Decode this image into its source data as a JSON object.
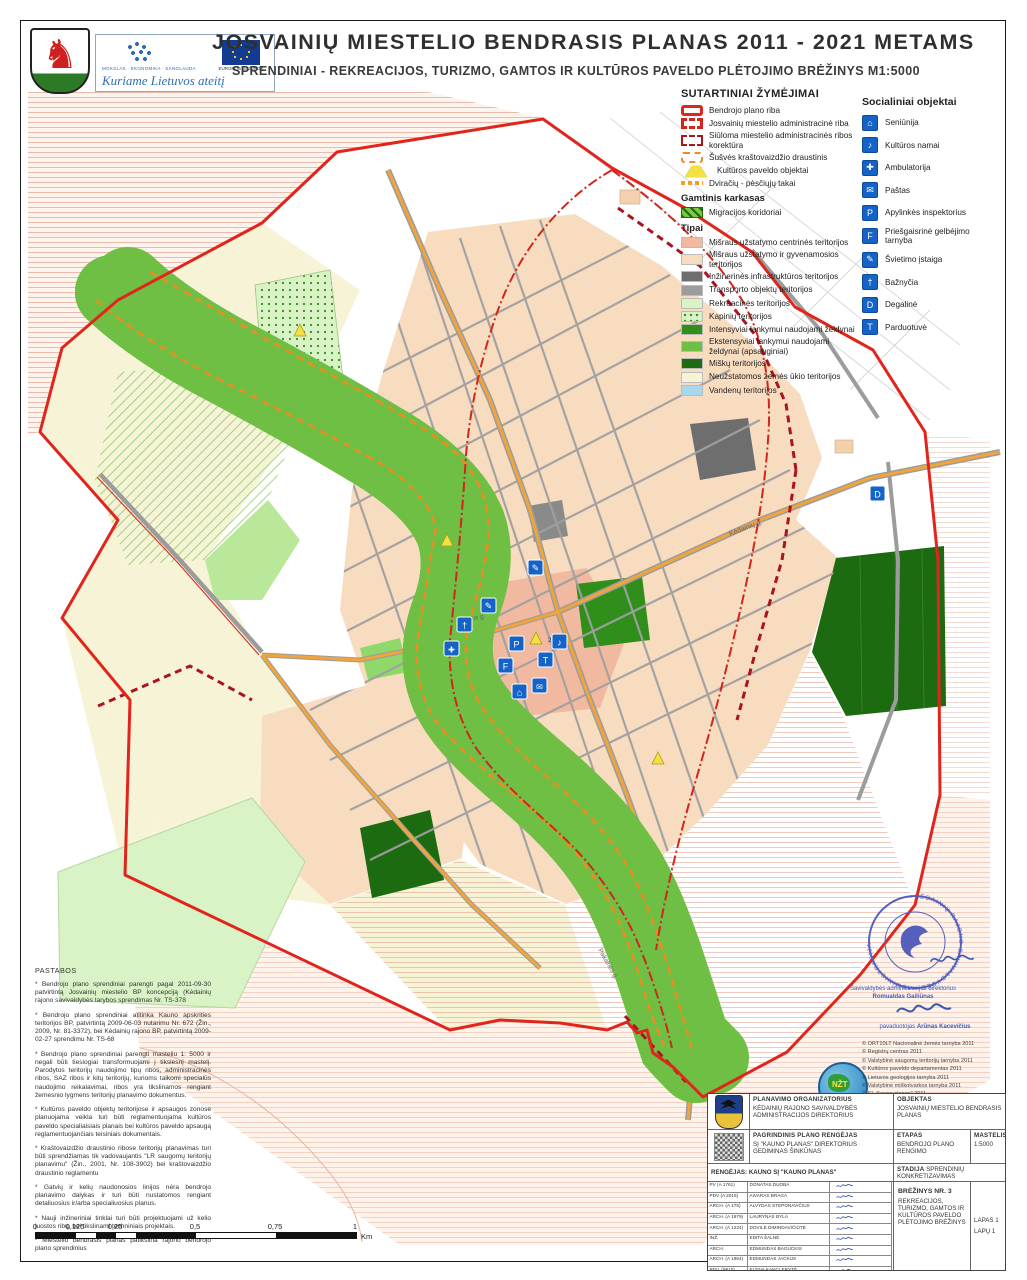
{
  "header": {
    "title": "JOSVAINIŲ MIESTELIO BENDRASIS PLANAS 2011 - 2021 METAMS",
    "subtitle": "SPRENDINIAI - REKREACIJOS, TURIZMO, GAMTOS IR KULTŪROS PAVELDO PLĖTOJIMO BRĖŽINYS M1:5000",
    "program_line": "MOKSLAS · EKONOMIKA · SANGLAUDA",
    "program_slogan": "Kuriame Lietuvos ateitį",
    "eu_label": "EUROPOS SĄJUNGA"
  },
  "legend": {
    "title": "SUTARTINIAI ŽYMĖJIMAI",
    "boundary_items": [
      {
        "label": "Bendrojo plano riba"
      },
      {
        "label": "Josvainių miestelio administracinė riba"
      },
      {
        "label": "Siūloma miestelio administracinės ribos korektūra"
      },
      {
        "label": "Šušvės kraštovaizdžio draustinis"
      },
      {
        "label": "Kultūros paveldo objektai"
      },
      {
        "label": "Dviračių - pėsčiųjų takai"
      }
    ],
    "nature_title": "Gamtinis karkasas",
    "nature_items": [
      {
        "label": "Migracijos koridoriai"
      }
    ],
    "types_title": "Tipai",
    "type_items": [
      {
        "label": "Mišraus užstatymo centrinės teritorijos",
        "color": "#f2b9a1"
      },
      {
        "label": "Mišraus užstatymo ir gyvenamosios teritorijos",
        "color": "#f8dcc0"
      },
      {
        "label": "Inžinerinės infrastruktūros teritorijos",
        "color": "#6e6e6e"
      },
      {
        "label": "Transporto objektų teritorijos",
        "color": "#9c9c9c"
      },
      {
        "label": "Rekreacinės teritorijos",
        "color": "#d9f2c6"
      },
      {
        "label": "Kapinių teritorijos",
        "color": "#d9f2c6"
      },
      {
        "label": "Intensyviai lankymui naudojami želdynai",
        "color": "#2f8f1a"
      },
      {
        "label": "Ekstensyviai lankymui naudojami želdynai (apsauginiai)",
        "color": "#6fbf44"
      },
      {
        "label": "Miškų teritorijos",
        "color": "#1d6b10"
      },
      {
        "label": "Neužstatomos žemės ūkio teritorijos",
        "color": "#f7f3d7"
      },
      {
        "label": "Vandenų teritorijos",
        "color": "#a8d8ee"
      }
    ]
  },
  "social": {
    "title": "Socialiniai objektai",
    "items": [
      {
        "label": "Seniūnija",
        "glyph": "⌂"
      },
      {
        "label": "Kultūros namai",
        "glyph": "♪"
      },
      {
        "label": "Ambulatorija",
        "glyph": "✚"
      },
      {
        "label": "Paštas",
        "glyph": "✉"
      },
      {
        "label": "Apylinkės inspektorius",
        "glyph": "P"
      },
      {
        "label": "Priešgaisrinė gelbėjimo tarnyba",
        "glyph": "F"
      },
      {
        "label": "Švietimo įstaiga",
        "glyph": "✎"
      },
      {
        "label": "Bažnyčia",
        "glyph": "†"
      },
      {
        "label": "Degalinė",
        "glyph": "D"
      },
      {
        "label": "Parduotuvė",
        "glyph": "T"
      }
    ]
  },
  "map_labels": {
    "street1": "Kėdainių g.",
    "street2": "Gojaus g.",
    "street3": "Pakalnės g.",
    "heritage_no": "21311"
  },
  "notes": {
    "title": "PASTABOS",
    "paragraphs": [
      "* Bendrojo plano sprendiniai parengti pagal 2011-09-30 patvirtintą Josvainių miestelio BP koncepciją (Kėdainių rajono savivaldybės tarybos sprendimas Nr. TS-378",
      "* Bendrojo plano sprendiniai atitinka Kauno apskrities teritorijos BP, patvirtintą 2009-06-03 nutarimu Nr. 672 (Žin., 2009, Nr. 81-3372), bei Kėdainių rajono BP, patvirtintą 2009-02-27 sprendimu Nr. TS-68",
      "* Bendrojo plano sprendiniai parengti masteliu 1: 5000 ir negali būti tiesiogiai transformuojami į tikslesnį mastelį. Parodytos teritorijų naudojimo tipų ribos, administracinės ribos, SAZ ribos ir kitų teritorijų, kurioms taikomi specialūs naudojimo reikalavimai, ribos yra tikslinamos rengiant žemesnio lygmens teritorijų planavimo dokumentus.",
      "* Kultūros paveldo objektų teritorijose ir apsaugos zonose planuojama veikla turi būti reglamentuojama kultūros paveldo specialiaisiais planais bei kultūros paveldo apsaugą reglamentuojančiais teisiniais dokumentais.",
      "* Kraštovaizdžio draustinio ribose teritorijų planavimas turi būti sprendžiamas tik vadovaujantis \"LR saugomų teritorijų planavimu\" (Žin., 2001, Nr. 108-3902) bei kraštovaizdžio draustinio reglamentu",
      "* Gatvių ir kelių naudonosios linijos nėra bendrojo planavimo dalykas ir turi būti nustatomos rengiant detaliuosius ir/arba specialiuosius planus.",
      "* Nauji inžineriniai tinklai turi būti projektuojami už kelio juostos ribų, bei tikslinami techniniais projektais.",
      "* Miestelio bendrasis planas patikslina rajono bendrojo plano sprendinius"
    ]
  },
  "scalebar": {
    "ticks": [
      "0",
      "0,125",
      "0,25",
      "0,5",
      "0,75",
      "1"
    ],
    "unit": "Km"
  },
  "credits": {
    "lines": [
      "© ORT10LT Nacionalinė žemės tarnyba  2011",
      "© Registrų centras 2011",
      "© Valstybinė saugomų teritorijų tarnyba 2011",
      "© Kultūros paveldo departamentas 2011",
      "© Lietuvos geologijos tarnyba 2011",
      "© Valstybinė miškotvarkos tarnyba 2011",
      "© SĮ „Kauno planas\" 2011",
      "© Kėdainių rajono savivaldybė  2011",
      "Atlikta naudojant ArcGIS programinę įrangą"
    ]
  },
  "stamp": {
    "ring_text": "KĖDAINIŲ RAJONO SAVIVALDYBĖS • ADMINISTRACIJA •",
    "sig1_role": "Savivaldybės administracijos direktorius",
    "sig1_name": "Romualdas Gailiūnas",
    "sig2_role": "pavaduotojas",
    "sig2_name": "Arūnas Kacevičius"
  },
  "titleblock": {
    "org_label": "PLANAVIMO ORGANIZATORIUS",
    "org_value": "KĖDAINIŲ RAJONO SAVIVALDYBĖS ADMINISTRACIJOS DIREKTORIUS",
    "obj_label": "OBJEKTAS",
    "obj_value": "JOSVAINIŲ MIESTELIO BENDRASIS PLANAS",
    "reng_label": "PAGRINDINIS PLANO RENGĖJAS",
    "reng_value": "SĮ \"KAUNO PLANAS\" DIREKTORIUS GEDIMINAS ŠINKŪNAS",
    "etapas_label": "ETAPAS",
    "etapas_value": "BENDROJO PLANO RENGIMO",
    "mastelis_label": "MASTELIS",
    "mastelis_value": "1:5000",
    "rengejas_row": "RENGĖJAS: KAUNO SĮ \"KAUNO PLANAS\"",
    "stadija_label": "STADIJA",
    "stadija_value": "SPRENDINIŲ KONKRETIZAVIMAS",
    "brezinys_label": "BRĖŽINYS NR. 3",
    "brezinys_value": "REKREACIJOS, TURIZMO, GAMTOS IR KULTŪROS PAVELDO PLĖTOJIMO BRĖŽINYS",
    "lapas": "LAPAS 1",
    "lapu": "LAPŲ 1",
    "team": [
      {
        "code": "PV (A 1761)",
        "name": "DONATAS DUOBA"
      },
      {
        "code": "PDV (A 2015)",
        "name": "AIVARAS BRAGA"
      },
      {
        "code": "ARCH. (A 175)",
        "name": "ALVYDAS STEPONAVIČIUS"
      },
      {
        "code": "ARCH. (A 1979)",
        "name": "LAURYNAS BYLA"
      },
      {
        "code": "ARCH. (A 1224)",
        "name": "DOVILĖ DIMINDAVIČIŪTĖ"
      },
      {
        "code": "INŽ.",
        "name": "EDITA ŠALNĖ"
      },
      {
        "code": "ARCH.",
        "name": "EDMUNDAS BAGUCKIS"
      },
      {
        "code": "ARCH. (A 1964)",
        "name": "EDMUNDAS JACKUS"
      },
      {
        "code": "PDV. (9810)",
        "name": "ELENA KANCLERYTĖ"
      },
      {
        "code": "ARCH. (A 1700)",
        "name": "JURGA MISIŪNĖ"
      },
      {
        "code": "ARCH. (A 1707)",
        "name": "MARIUS IVAŠKEVIČIUS"
      },
      {
        "code": "NKPS NR. (0720)",
        "name": "NIJOLĖ STEPONAITYTĖ"
      },
      {
        "code": "PDV (17744)",
        "name": "ZITA NORMANTIENĖ"
      }
    ]
  },
  "colors": {
    "plan_boundary": "#e1251c",
    "admin_boundary": "#d0261c",
    "correction": "#a8151f",
    "reserve": "#ef8b1f",
    "path_dots": "#f0a028",
    "corridor": "#4aa62c",
    "river": "#3f93df",
    "icon_blue": "#1663c7"
  }
}
